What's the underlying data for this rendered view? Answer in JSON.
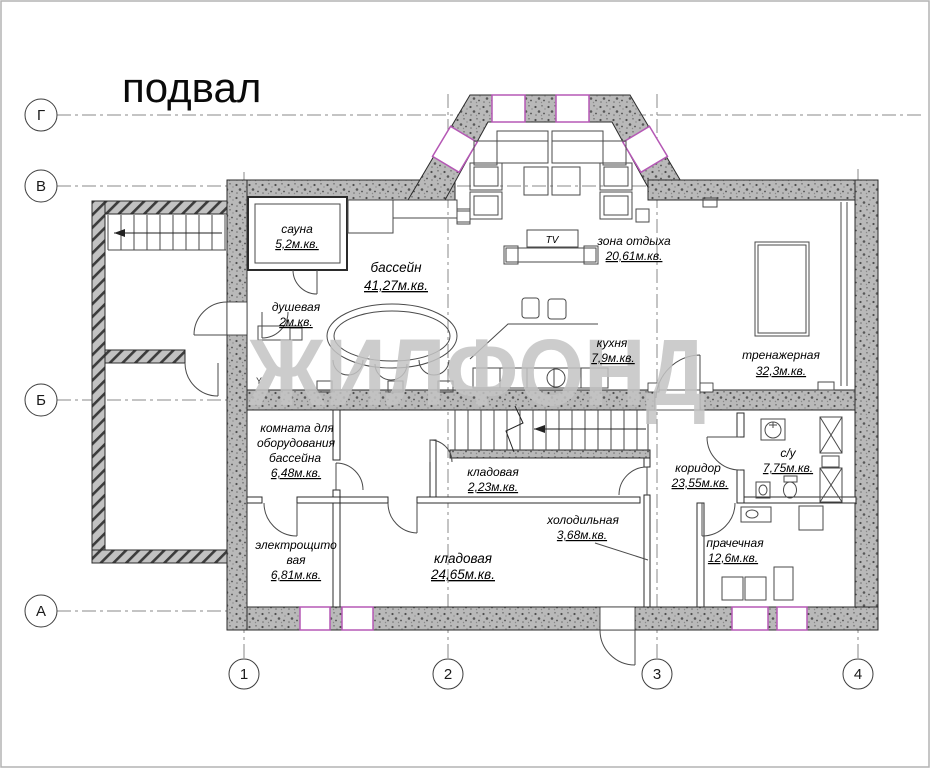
{
  "title": "подвал",
  "watermark": "ЖИЛФОНД",
  "axes": {
    "horizontal": [
      "Г",
      "В",
      "Б",
      "А"
    ],
    "vertical": [
      "1",
      "2",
      "3",
      "4"
    ]
  },
  "labels": {
    "tv": "TV"
  },
  "rooms": {
    "sauna": {
      "name": "сауна",
      "area": "5,2м.кв."
    },
    "pool": {
      "name": "бассейн",
      "area": "41,27м.кв."
    },
    "shower": {
      "name": "душевая",
      "area": "2м.кв."
    },
    "lounge": {
      "name": "зона отдыха",
      "area": "20,61м.кв."
    },
    "kitchen": {
      "name": "кухня",
      "area": "7,9м.кв."
    },
    "gym": {
      "name": "тренажерная",
      "area": "32,3м.кв."
    },
    "pool_equipment": {
      "line1": "комната для",
      "line2": "оборудования",
      "line3": "бассейна",
      "area": "6,48м.кв."
    },
    "storage_small": {
      "name": "кладовая",
      "area": "2,23м.кв."
    },
    "corridor": {
      "name": "коридор",
      "area": "23,55м.кв."
    },
    "bathroom": {
      "name": "с/у",
      "area": "7,75м.кв."
    },
    "cold_room": {
      "name": "холодильная",
      "area": "3,68м.кв."
    },
    "electrical": {
      "line1": "электрощито",
      "line2": "вая",
      "area": "6,81м.кв."
    },
    "storage_large": {
      "name": "кладовая",
      "area": "24,65м.кв."
    },
    "laundry": {
      "name": "прачечная",
      "area": "12,6м.кв."
    }
  },
  "colors": {
    "wall_fill": "#b9b9b9",
    "window_accent": "#b558b5",
    "watermark": "#c4c4c4",
    "line": "#2b2b2b"
  }
}
